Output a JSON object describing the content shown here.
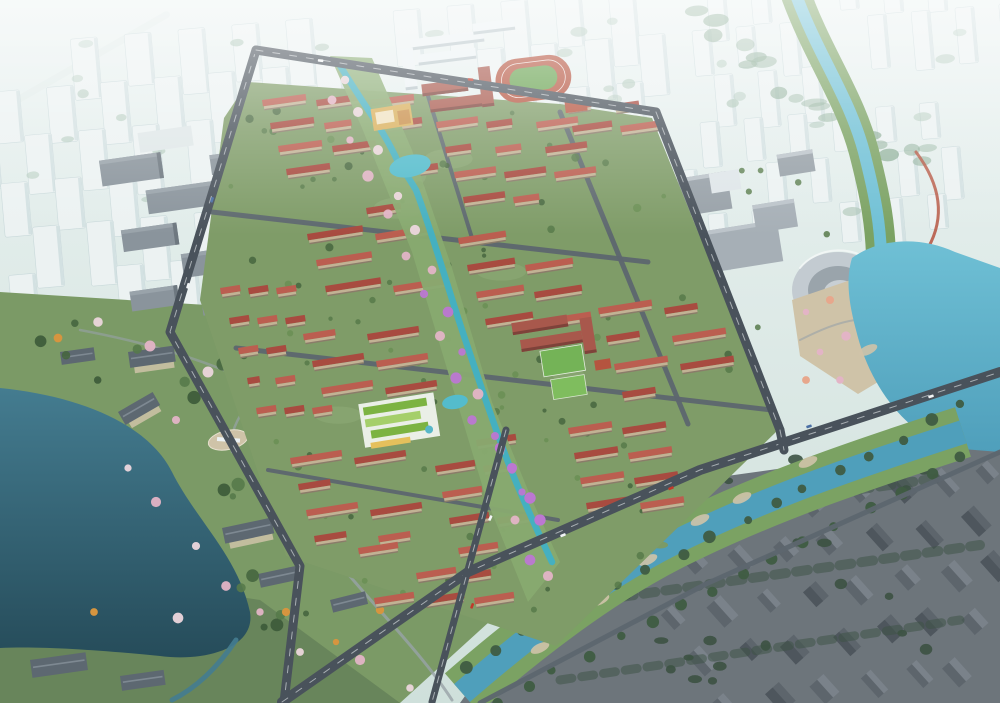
{
  "scene": {
    "type": "aerial-architectural-rendering",
    "description": "Bird's-eye 3D rendering of a residential masterplan: rows of red-roofed housing blocks around a central landscaped stream axis lined with cherry blossoms; a school campus with a running track to the north; a lake and wooded parkland with traditional courtyard buildings to the west; gray industrial blocks mid-left; a commercial district with towers, a stadium and a waterfront plaza on a bright lake to the east; a river and canal with green banks crossing the south; an existing dark-roofed village to the southeast; all surrounded by a hazy white city skyline.",
    "features": [
      "hazy-city-skyline",
      "viaduct",
      "school-campus",
      "running-track",
      "sports-courts",
      "red-roof-residential-blocks",
      "central-green-axis",
      "stream",
      "pond",
      "blossom-trees",
      "retail-center",
      "kindergarten",
      "west-lake",
      "parkland",
      "traditional-courtyard-buildings",
      "oval-plaza",
      "industrial-blocks",
      "commercial-district",
      "office-towers",
      "stadium",
      "waterfront-plaza",
      "east-lake",
      "river",
      "canal",
      "riverbank-beaches",
      "village-blocks",
      "roads",
      "bridges",
      "cars"
    ]
  },
  "palette": {
    "sky_haze_top": "#eaf2f1",
    "sky_haze_bottom": "#cfe0db",
    "haze_building": "#edf3f3",
    "haze_building_edge": "#c8d8da",
    "haze_tree": "#a3bfae",
    "forest_muted": "#7fa389",
    "viaduct_light": "#e2ebe9",
    "park_green_light": "#8fac77",
    "park_green": "#7b9a66",
    "park_green_dark": "#55704f",
    "tree_green_1": "#46663f",
    "tree_green_2": "#577a4a",
    "tree_green_3": "#3c5a38",
    "lake_deep": "#264c5a",
    "lake_mid": "#447c90",
    "lake_bright": "#6fc0d5",
    "lake_bright_deep": "#4f9fbb",
    "stream_teal": "#41b0c4",
    "pond_teal": "#54bccc",
    "river_bank_green": "#7ba263",
    "road_dark": "#49525b",
    "road_light": "#5d666f",
    "road_marking": "#e8ecef",
    "path_gray": "#98a2a8",
    "dev_base": "#7f9c68",
    "roof_red": "#a84b40",
    "roof_red_light": "#bb5e50",
    "facade_tan": "#c2b294",
    "facade_shadow": "#8a7c69",
    "gray_roof": "#5d6871",
    "gray_ridge": "#7e8992",
    "white_building": "#ecf2f4",
    "white_building_shade": "#b9c6ca",
    "industrial_gray": "#8a949c",
    "industrial_dark": "#6e7880",
    "commercial_gray": "#98a1a8",
    "commercial_light": "#aeb7bd",
    "village_base": "#6d757b",
    "village_roof_light": "#7a828a",
    "village_roof_dark": "#5d656c",
    "village_tree": "#3c5243",
    "blossom_pink": "#e3b4c6",
    "blossom_purple": "#bc77d2",
    "blossom_white": "#ecd6dc",
    "blossom_salmon": "#e7a78c",
    "autumn_orange": "#d6953f",
    "track_red": "#b5543f",
    "field_green": "#67a24f",
    "court_green": "#74b357",
    "school_red": "#a8584c",
    "kg_green": "#7cb342",
    "kg_green_light": "#a5cf6a",
    "kg_white": "#f0f3ee",
    "kg_yellow": "#e5c05c",
    "retail_gold": "#d9b05c",
    "retail_cream": "#f0e3c2",
    "retail_amber": "#c98f4a",
    "plaza_beige": "#cfc3a8",
    "stadium_gray": "#c3cbd1",
    "car_white": "#f2f5f6",
    "car_red": "#c0392b",
    "car_blue": "#4a6fa5"
  }
}
